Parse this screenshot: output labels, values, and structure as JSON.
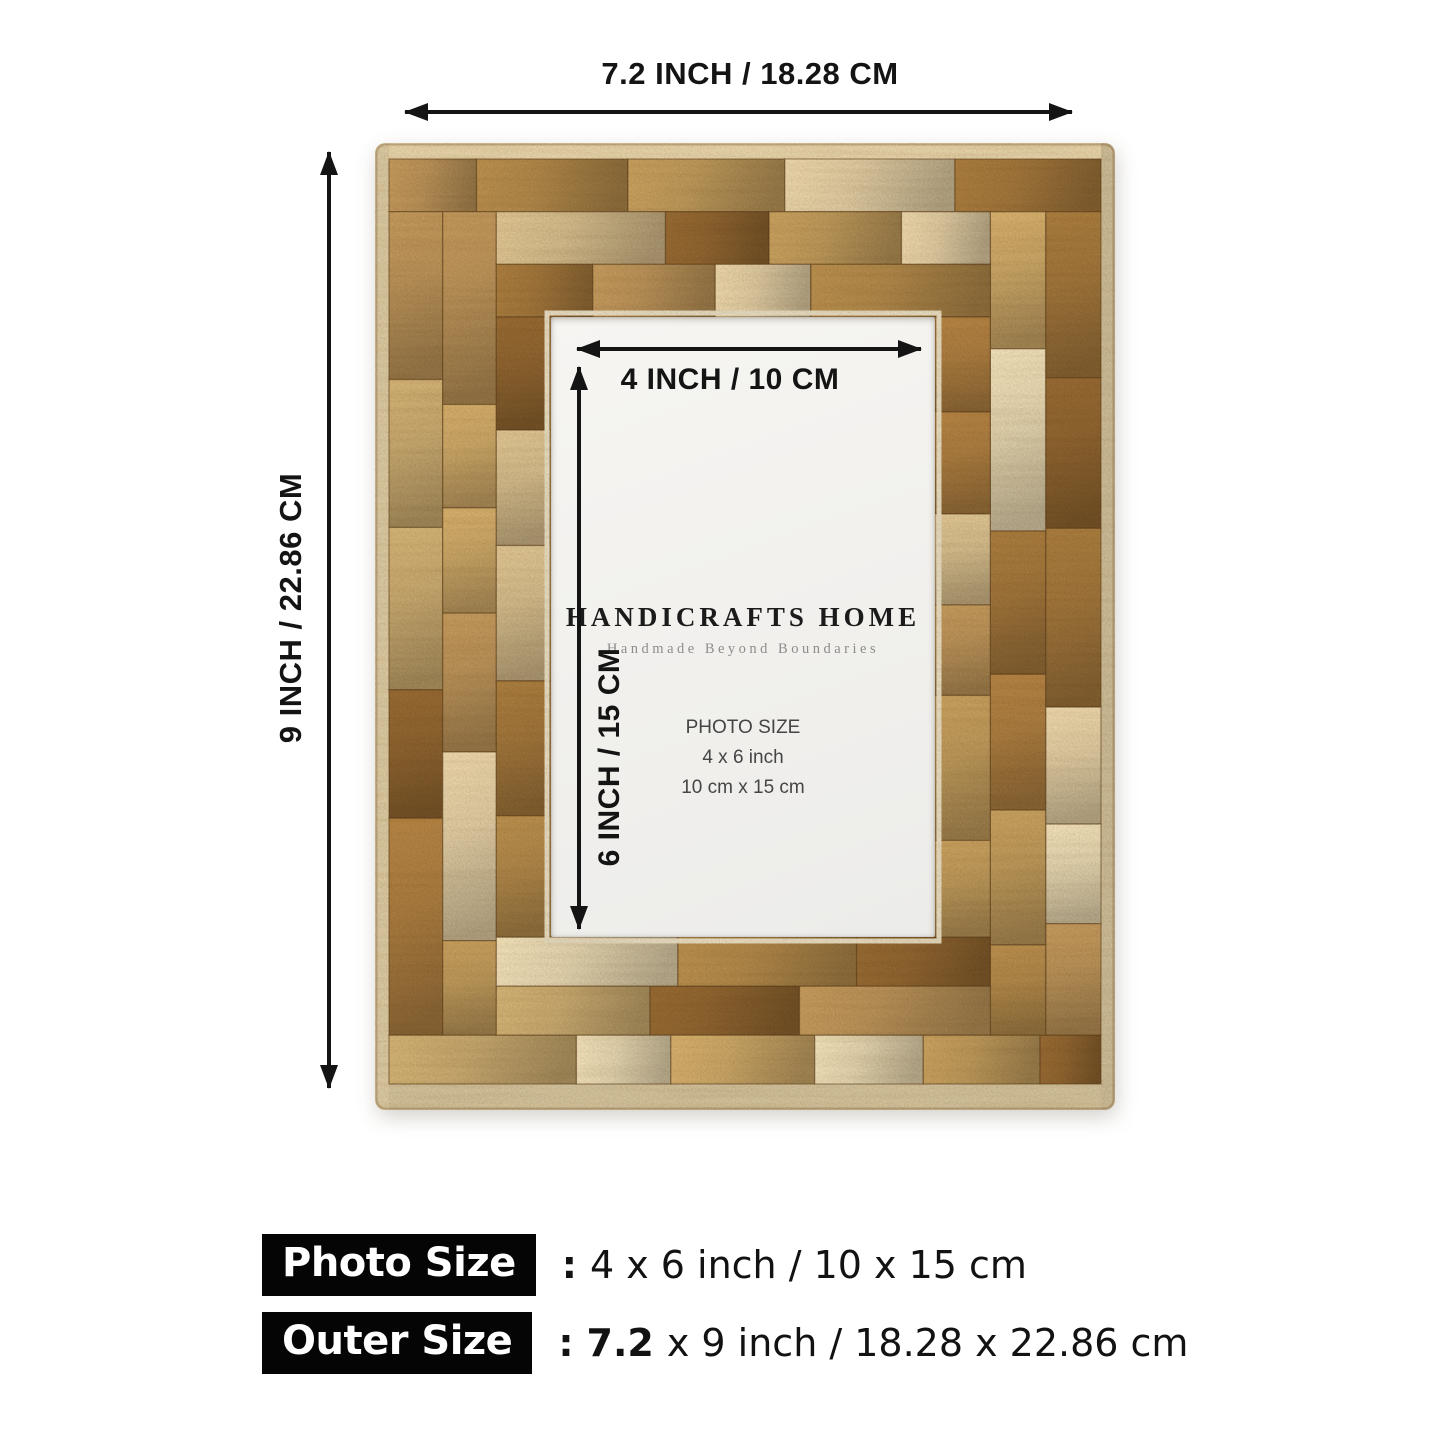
{
  "annotations": {
    "outer_width": "7.2 INCH / 18.28 CM",
    "outer_height": "9 INCH / 22.86 CM",
    "inner_width": "4 INCH / 10 CM",
    "inner_height": "6 INCH / 15 CM"
  },
  "insert": {
    "brand": "HANDICRAFTS HOME",
    "tagline": "Handmade Beyond Boundaries",
    "photo_size_title": "PHOTO SIZE",
    "photo_size_inch": "4 x 6 inch",
    "photo_size_cm": "10 cm x 15 cm"
  },
  "summary": {
    "rows": [
      {
        "label": "Photo Size",
        "colon": ":",
        "text": "4 x 6 inch / 10 x 15 cm"
      },
      {
        "label": "Outer Size",
        "colon": ":",
        "bold": "7.2",
        "text": "x 9 inch / 18.28 x 22.86 cm"
      }
    ]
  },
  "colors": {
    "annotation": "#141414",
    "badge_bg": "#050505",
    "badge_text": "#ffffff",
    "tagline_gray": "#8c8c8c"
  },
  "frame": {
    "palette": [
      "#dfcda6",
      "#d3bd8f",
      "#c8ab72",
      "#bd9a5c",
      "#b0894b",
      "#a1773c",
      "#8f6530",
      "#e3d6b3",
      "#caa869",
      "#b9935a",
      "#ab7e41"
    ],
    "edge_color": "#ddcda7",
    "base_color": "#b68c52",
    "seam_color": "rgba(92,62,26,0.5)"
  }
}
